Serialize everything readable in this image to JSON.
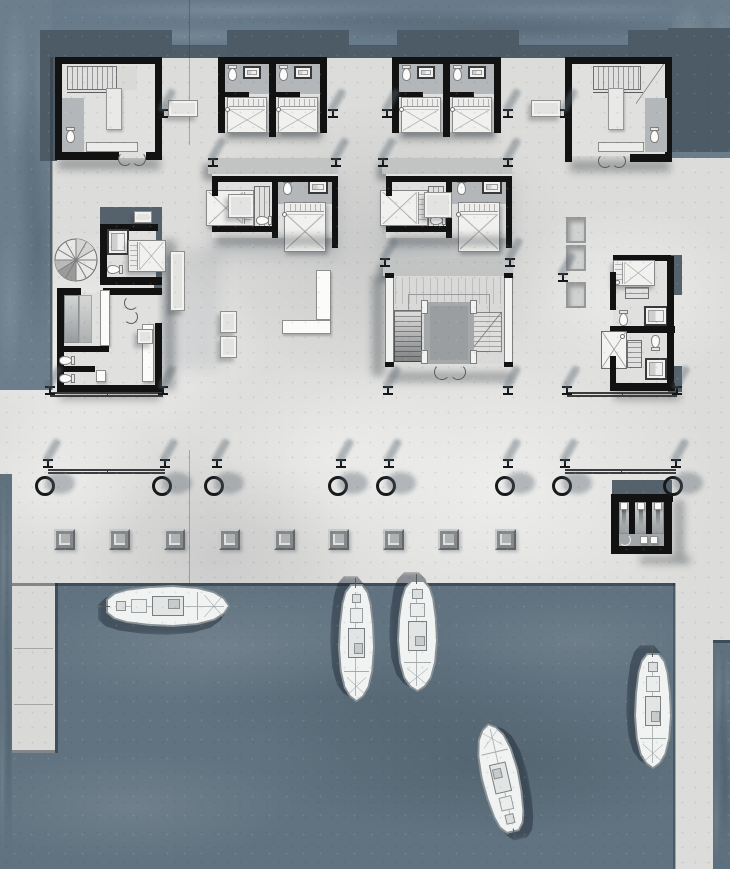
{
  "meta": {
    "title": "Waterfront hotel deck — ground floor plan with marina",
    "type": "architectural-site-plan",
    "visible_text": "none"
  },
  "palette": {
    "deck": "#dcdcda",
    "deck_light": "#efefed",
    "pier": "#d9d9d7",
    "water_top": "#687b8a",
    "water_basin": "#617380",
    "roof_shadow": "#4d5b66",
    "wall": "#121212",
    "canopy_slab": "#c2c4c3",
    "slate_slab": "#55626c",
    "furniture_white": "#f1f1ef",
    "bath_floor": "#b3b7b9",
    "boat_hull": "#f1f3f2",
    "boat_outline": "#8b9296"
  },
  "scene": {
    "posts": [
      [
        163,
        113
      ],
      [
        333,
        113
      ],
      [
        387,
        113
      ],
      [
        508,
        113
      ],
      [
        565,
        113
      ],
      [
        213,
        162
      ],
      [
        336,
        162
      ],
      [
        383,
        162
      ],
      [
        508,
        162
      ],
      [
        385,
        262
      ],
      [
        510,
        262
      ],
      [
        563,
        277
      ],
      [
        50,
        390
      ],
      [
        163,
        390
      ],
      [
        388,
        390
      ],
      [
        508,
        390
      ],
      [
        567,
        390
      ],
      [
        677,
        390
      ],
      [
        48,
        463
      ],
      [
        165,
        463
      ],
      [
        217,
        463
      ],
      [
        341,
        463
      ],
      [
        389,
        463
      ],
      [
        508,
        463
      ],
      [
        565,
        463
      ],
      [
        676,
        463
      ]
    ],
    "bollards": {
      "y": 476,
      "xs": [
        48,
        165,
        217,
        341,
        389,
        508,
        565,
        676
      ]
    },
    "railings": [
      [
        50,
        163,
        392
      ],
      [
        567,
        677,
        392
      ],
      [
        48,
        165,
        469
      ],
      [
        565,
        676,
        469
      ]
    ],
    "stools": {
      "y": 529,
      "xs": [
        54,
        109,
        164,
        219,
        274,
        328,
        383,
        438,
        495
      ]
    },
    "planters": [
      [
        566,
        217
      ],
      [
        566,
        245
      ],
      [
        566,
        282
      ]
    ],
    "benches": [
      [
        168,
        100,
        30,
        17
      ],
      [
        531,
        100,
        30,
        17
      ],
      [
        228,
        194,
        26,
        24
      ],
      [
        424,
        192,
        28,
        26
      ],
      [
        170,
        251,
        15,
        60
      ],
      [
        220,
        311,
        17,
        22
      ],
      [
        220,
        336,
        17,
        22
      ],
      [
        137,
        329,
        16,
        15
      ],
      [
        134,
        211,
        18,
        12
      ]
    ],
    "boats": [
      {
        "name": "boat-moored-west",
        "cx": 168,
        "cy": 606,
        "len": 124,
        "beam": 42,
        "rot": 90
      },
      {
        "name": "boat-moored-center-left",
        "cx": 356,
        "cy": 643,
        "len": 118,
        "beam": 37,
        "rot": 180
      },
      {
        "name": "boat-moored-center",
        "cx": 417,
        "cy": 636,
        "len": 112,
        "beam": 41,
        "rot": 180
      },
      {
        "name": "boat-anchored-bay",
        "cx": 500,
        "cy": 778,
        "len": 112,
        "beam": 39,
        "rot": -13
      },
      {
        "name": "boat-moored-east",
        "cx": 653,
        "cy": 711,
        "len": 116,
        "beam": 38,
        "rot": 180
      }
    ]
  }
}
